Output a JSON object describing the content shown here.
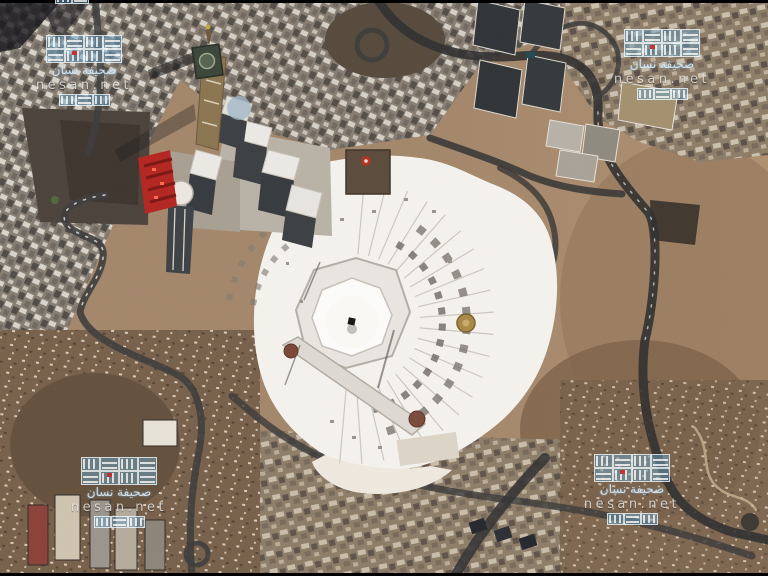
{
  "watermark": {
    "site_label": "nesan.net",
    "arabic_label": "صحيفة نسان",
    "color_blue": "#8fbcd8",
    "accent_red": "#c43030",
    "positions": [
      "top-left",
      "top-right",
      "bottom-left",
      "bottom-right"
    ]
  },
  "scene_colors": {
    "terrain_tan": "#a3866a",
    "hill_brown": "#6e5943",
    "road_dark": "#333333",
    "mosque_white": "#f5f3ef",
    "kaaba_black": "#141414",
    "gold_dome": "#a88844",
    "led_screen_red": "#b42420",
    "tower_dark": "#35393d",
    "clock_tower_bronze": "#8a7450"
  }
}
